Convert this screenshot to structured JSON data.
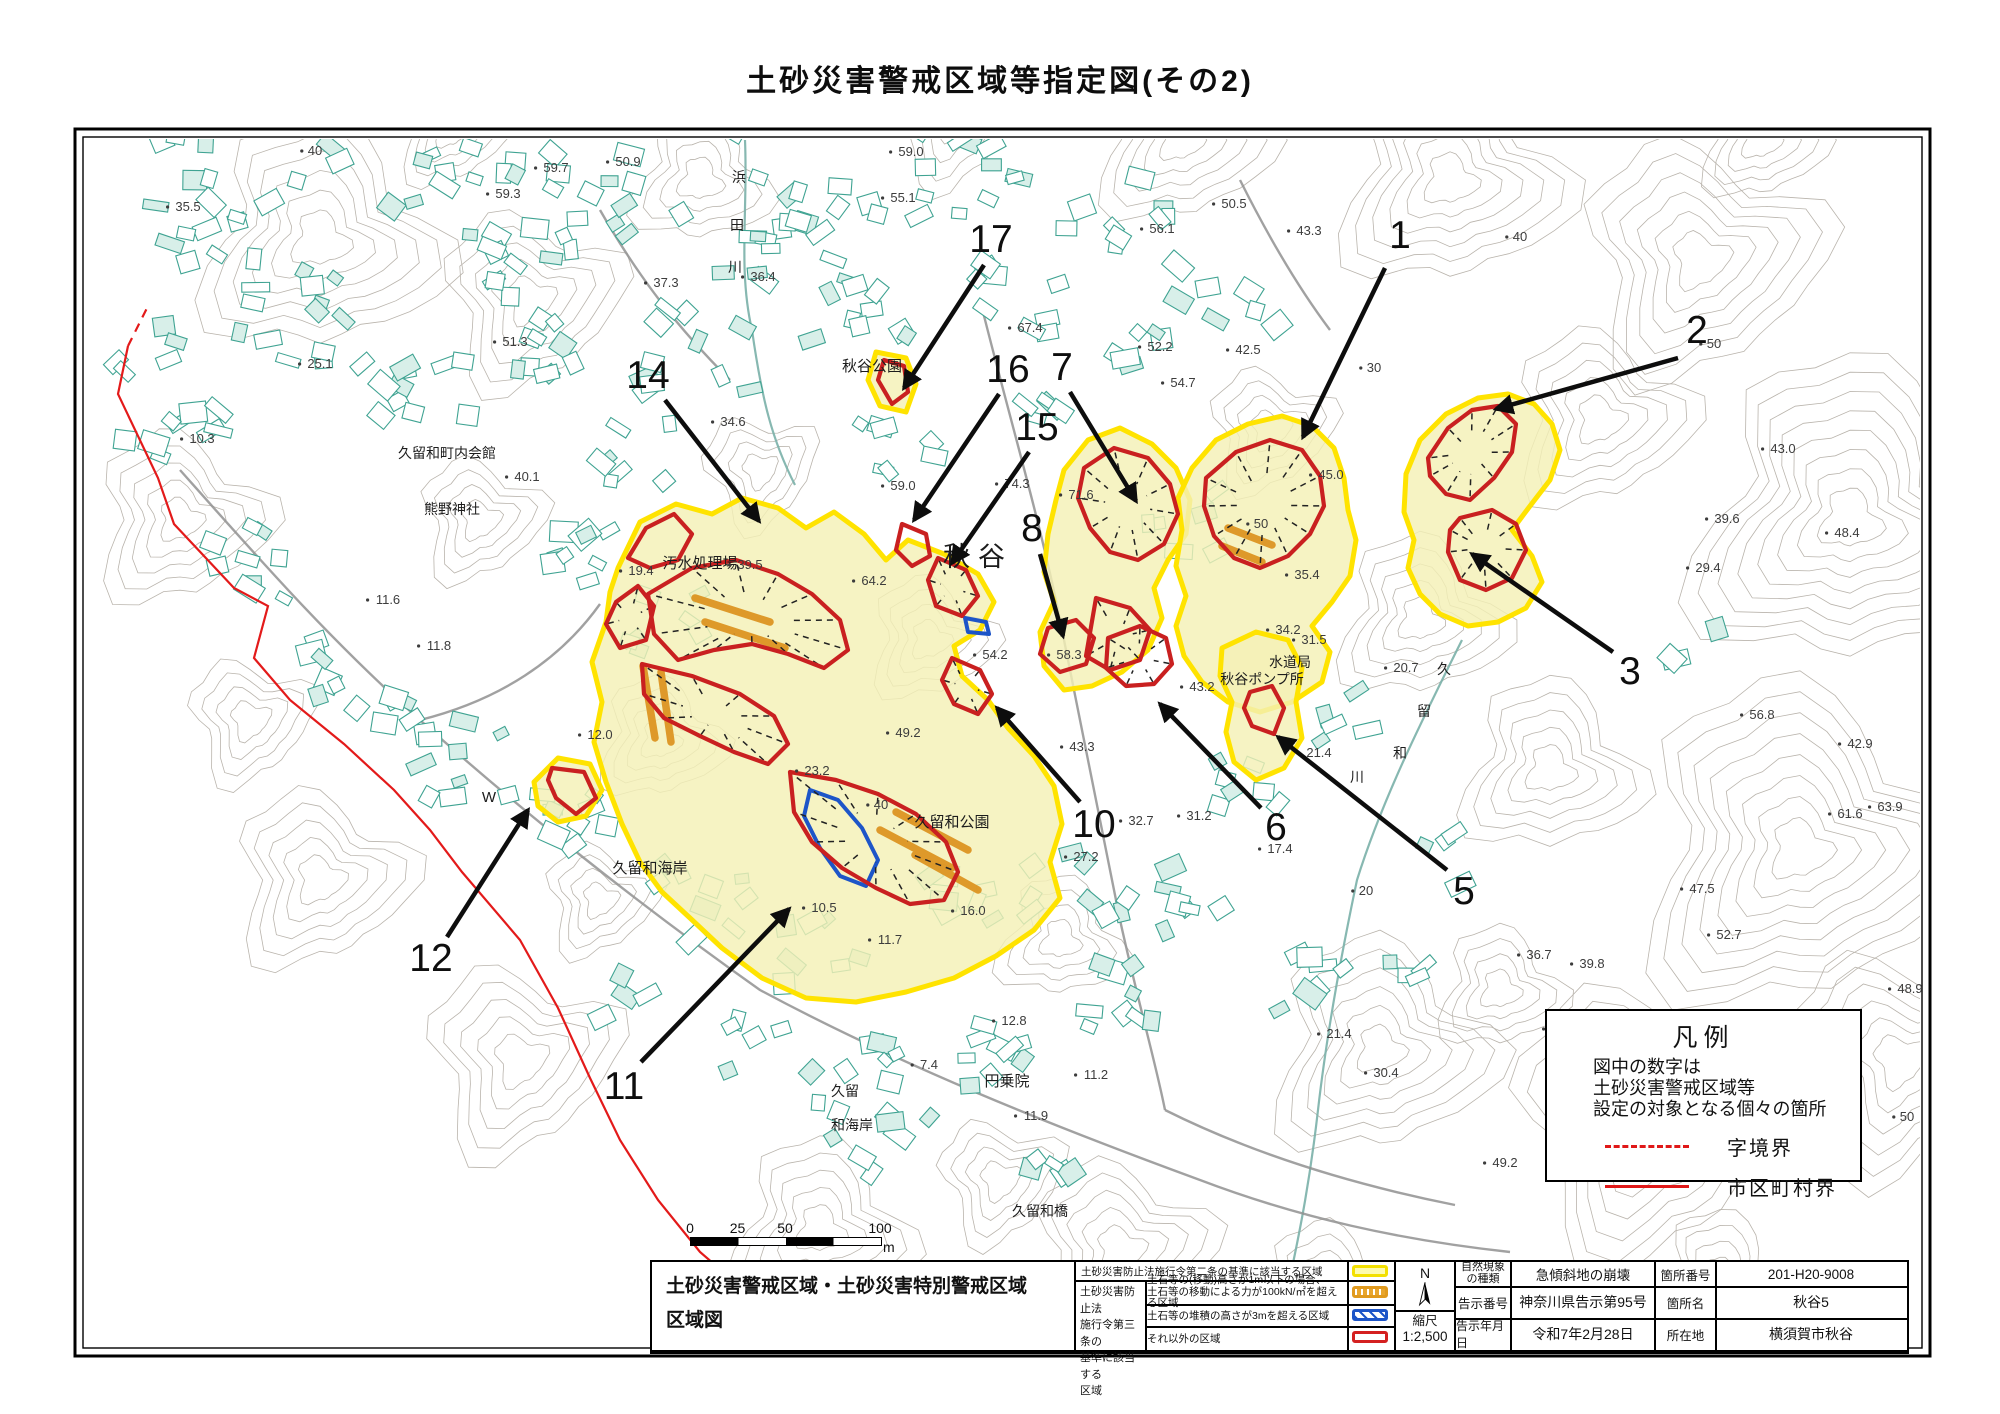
{
  "title": "土砂災害警戒区域等指定図(その2)",
  "map": {
    "place_labels": [
      {
        "t": "秋谷",
        "x": 978,
        "y": 566,
        "s": 27,
        "ls": 8
      },
      {
        "t": "秋谷公園",
        "x": 872,
        "y": 371,
        "s": 15
      },
      {
        "t": "汚水処理場",
        "x": 700,
        "y": 568,
        "s": 15
      },
      {
        "t": "久留和町内会館",
        "x": 447,
        "y": 458,
        "s": 14
      },
      {
        "t": "熊野神社",
        "x": 452,
        "y": 514,
        "s": 14
      },
      {
        "t": "久留和公園",
        "x": 952,
        "y": 827,
        "s": 15
      },
      {
        "t": "久留和海岸",
        "x": 650,
        "y": 873,
        "s": 15
      },
      {
        "t": "久留",
        "x": 845,
        "y": 1096,
        "s": 14
      },
      {
        "t": "和海岸",
        "x": 852,
        "y": 1130,
        "s": 14
      },
      {
        "t": "円乗院",
        "x": 1007,
        "y": 1086,
        "s": 15
      },
      {
        "t": "久留和橋",
        "x": 1040,
        "y": 1216,
        "s": 14
      },
      {
        "t": "水道局",
        "x": 1290,
        "y": 667,
        "s": 14
      },
      {
        "t": "秋谷ポンプ所",
        "x": 1262,
        "y": 684,
        "s": 14
      },
      {
        "t": "浜",
        "x": 739,
        "y": 182,
        "s": 14
      },
      {
        "t": "田",
        "x": 737,
        "y": 230,
        "s": 14
      },
      {
        "t": "川",
        "x": 735,
        "y": 272,
        "s": 14
      },
      {
        "t": "久",
        "x": 1444,
        "y": 674,
        "s": 14
      },
      {
        "t": "留",
        "x": 1424,
        "y": 716,
        "s": 14
      },
      {
        "t": "和",
        "x": 1400,
        "y": 758,
        "s": 14
      },
      {
        "t": "川",
        "x": 1357,
        "y": 782,
        "s": 14
      },
      {
        "t": "W",
        "x": 489,
        "y": 802,
        "s": 15
      }
    ],
    "elevation_labels": [
      [
        "40",
        315,
        155
      ],
      [
        "35.5",
        188,
        211
      ],
      [
        "59.7",
        556,
        172
      ],
      [
        "50.9",
        628,
        166
      ],
      [
        "59.3",
        508,
        198
      ],
      [
        "25.1",
        320,
        368
      ],
      [
        "51.3",
        515,
        346
      ],
      [
        "10.3",
        202,
        443
      ],
      [
        "40.1",
        527,
        481
      ],
      [
        "37.3",
        666,
        287
      ],
      [
        "36.4",
        763,
        281
      ],
      [
        "34.6",
        733,
        426
      ],
      [
        "59.0",
        911,
        156
      ],
      [
        "55.1",
        903,
        202
      ],
      [
        "56.1",
        1162,
        233
      ],
      [
        "50.5",
        1234,
        208
      ],
      [
        "43.3",
        1309,
        235
      ],
      [
        "40",
        1520,
        241
      ],
      [
        "50",
        1714,
        348
      ],
      [
        "67.4",
        1030,
        332
      ],
      [
        "52.2",
        1160,
        351
      ],
      [
        "42.5",
        1248,
        354
      ],
      [
        "54.7",
        1183,
        387
      ],
      [
        "30",
        1374,
        372
      ],
      [
        "74.3",
        1017,
        488
      ],
      [
        "71.6",
        1081,
        499
      ],
      [
        "59.0",
        903,
        490
      ],
      [
        "64.2",
        874,
        585
      ],
      [
        "19.4",
        641,
        575
      ],
      [
        "39.5",
        750,
        569
      ],
      [
        "45.0",
        1331,
        479
      ],
      [
        "50",
        1261,
        528
      ],
      [
        "35.4",
        1307,
        579
      ],
      [
        "43.0",
        1783,
        453
      ],
      [
        "39.6",
        1727,
        523
      ],
      [
        "48.4",
        1847,
        537
      ],
      [
        "29.4",
        1708,
        572
      ],
      [
        "34.2",
        1288,
        634
      ],
      [
        "31.5",
        1314,
        644
      ],
      [
        "20.7",
        1406,
        672
      ],
      [
        "56.8",
        1762,
        719
      ],
      [
        "42.9",
        1860,
        748
      ],
      [
        "43.2",
        1202,
        691
      ],
      [
        "54.2",
        995,
        659
      ],
      [
        "58.3",
        1069,
        659
      ],
      [
        "21.4",
        1319,
        757
      ],
      [
        "49.2",
        908,
        737
      ],
      [
        "43.3",
        1082,
        751
      ],
      [
        "61.6",
        1850,
        818
      ],
      [
        "63.9",
        1890,
        811
      ],
      [
        "32.7",
        1141,
        825
      ],
      [
        "31.2",
        1199,
        820
      ],
      [
        "27.2",
        1086,
        861
      ],
      [
        "17.4",
        1280,
        853
      ],
      [
        "20",
        1366,
        895
      ],
      [
        "23.2",
        817,
        775
      ],
      [
        "40",
        881,
        809
      ],
      [
        "47.5",
        1702,
        893
      ],
      [
        "52.7",
        1729,
        939
      ],
      [
        "36.7",
        1539,
        959
      ],
      [
        "39.8",
        1592,
        968
      ],
      [
        "48.9",
        1910,
        993
      ],
      [
        "39.1",
        1564,
        1033
      ],
      [
        "10.5",
        824,
        912
      ],
      [
        "11.7",
        890,
        944
      ],
      [
        "16.0",
        973,
        915
      ],
      [
        "12.0",
        600,
        739
      ],
      [
        "11.8",
        439,
        650
      ],
      [
        "11.6",
        388,
        604
      ],
      [
        "12.8",
        1014,
        1025
      ],
      [
        "7.4",
        929,
        1069
      ],
      [
        "11.2",
        1096,
        1079
      ],
      [
        "11.9",
        1036,
        1120
      ],
      [
        "21.4",
        1339,
        1038
      ],
      [
        "30.4",
        1386,
        1077
      ],
      [
        "50",
        1907,
        1121
      ],
      [
        "49.2",
        1505,
        1167
      ]
    ],
    "callouts": [
      {
        "num": "1",
        "x": 1400,
        "y": 248,
        "x1": 1385,
        "y1": 268,
        "x2": 1303,
        "y2": 437
      },
      {
        "num": "2",
        "x": 1697,
        "y": 343,
        "x1": 1678,
        "y1": 358,
        "x2": 1496,
        "y2": 409
      },
      {
        "num": "3",
        "x": 1630,
        "y": 684,
        "x1": 1613,
        "y1": 652,
        "x2": 1472,
        "y2": 554
      },
      {
        "num": "5",
        "x": 1464,
        "y": 904,
        "x1": 1447,
        "y1": 870,
        "x2": 1278,
        "y2": 737
      },
      {
        "num": "6",
        "x": 1276,
        "y": 840,
        "x1": 1261,
        "y1": 808,
        "x2": 1160,
        "y2": 704
      },
      {
        "num": "7",
        "x": 1062,
        "y": 380,
        "x1": 1070,
        "y1": 392,
        "x2": 1136,
        "y2": 501
      },
      {
        "num": "8",
        "x": 1032,
        "y": 541,
        "x1": 1040,
        "y1": 554,
        "x2": 1063,
        "y2": 636
      },
      {
        "num": "10",
        "x": 1094,
        "y": 837,
        "x1": 1080,
        "y1": 802,
        "x2": 997,
        "y2": 708
      },
      {
        "num": "11",
        "x": 624,
        "y": 1099,
        "x1": 641,
        "y1": 1062,
        "x2": 789,
        "y2": 909
      },
      {
        "num": "12",
        "x": 431,
        "y": 971,
        "x1": 447,
        "y1": 937,
        "x2": 528,
        "y2": 810
      },
      {
        "num": "14",
        "x": 648,
        "y": 388,
        "x1": 665,
        "y1": 400,
        "x2": 759,
        "y2": 521
      },
      {
        "num": "15",
        "x": 1037,
        "y": 440,
        "x1": 1029,
        "y1": 452,
        "x2": 952,
        "y2": 563
      },
      {
        "num": "16",
        "x": 1008,
        "y": 382,
        "x1": 999,
        "y1": 394,
        "x2": 914,
        "y2": 520
      },
      {
        "num": "17",
        "x": 991,
        "y": 252,
        "x1": 984,
        "y1": 265,
        "x2": 904,
        "y2": 388
      }
    ],
    "colors": {
      "warning_fill": "#f4f0b6",
      "warning_border": "#ffe300",
      "special_red": "#c92020",
      "orange_zone": "#dd9522",
      "blue_zone": "#1d55c8",
      "municipal_boundary": "#e31a1a",
      "building": "#3fa392",
      "contour": "#b6b0a8"
    }
  },
  "legend_box": {
    "title": "凡例",
    "note": "図中の数字は\n土砂災害警戒区域等\n設定の対象となる個々の箇所",
    "items": [
      {
        "style": "dashed",
        "label": "字境界"
      },
      {
        "style": "solid",
        "label": "市区町村界"
      }
    ]
  },
  "scale_bar": {
    "ticks": [
      "0",
      "25",
      "50",
      "100"
    ],
    "unit": "m"
  },
  "info_table": {
    "map_title": "土砂災害警戒区域・土砂災害特別警戒区域\n区域図",
    "law": {
      "row1": "土砂災害防止法施行令第二条の基準に該当する区域",
      "group": "土砂災害防止法\n施行令第三条の\n基準に該当する\n区域",
      "rows": [
        {
          "desc": "土石等の(移動)高さが1m以下の場合、\n土石等の移動による力が100kN/㎡を超える区域"
        },
        {
          "desc": "土石等の堆積の高さが3mを超える区域"
        },
        {
          "desc": "それ以外の区域"
        }
      ]
    },
    "north_label": "N",
    "scale_label": "縮尺",
    "scale_value": "1:2,500",
    "rows": [
      {
        "l1": "自然現象\nの種類",
        "v1": "急傾斜地の崩壊",
        "l2": "箇所番号",
        "v2": "201-H20-9008"
      },
      {
        "l1": "告示番号",
        "v1": "神奈川県告示第95号",
        "l2": "箇所名",
        "v2": "秋谷5"
      },
      {
        "l1": "告示年月日",
        "v1": "令和7年2月28日",
        "l2": "所在地",
        "v2": "横須賀市秋谷"
      }
    ]
  }
}
